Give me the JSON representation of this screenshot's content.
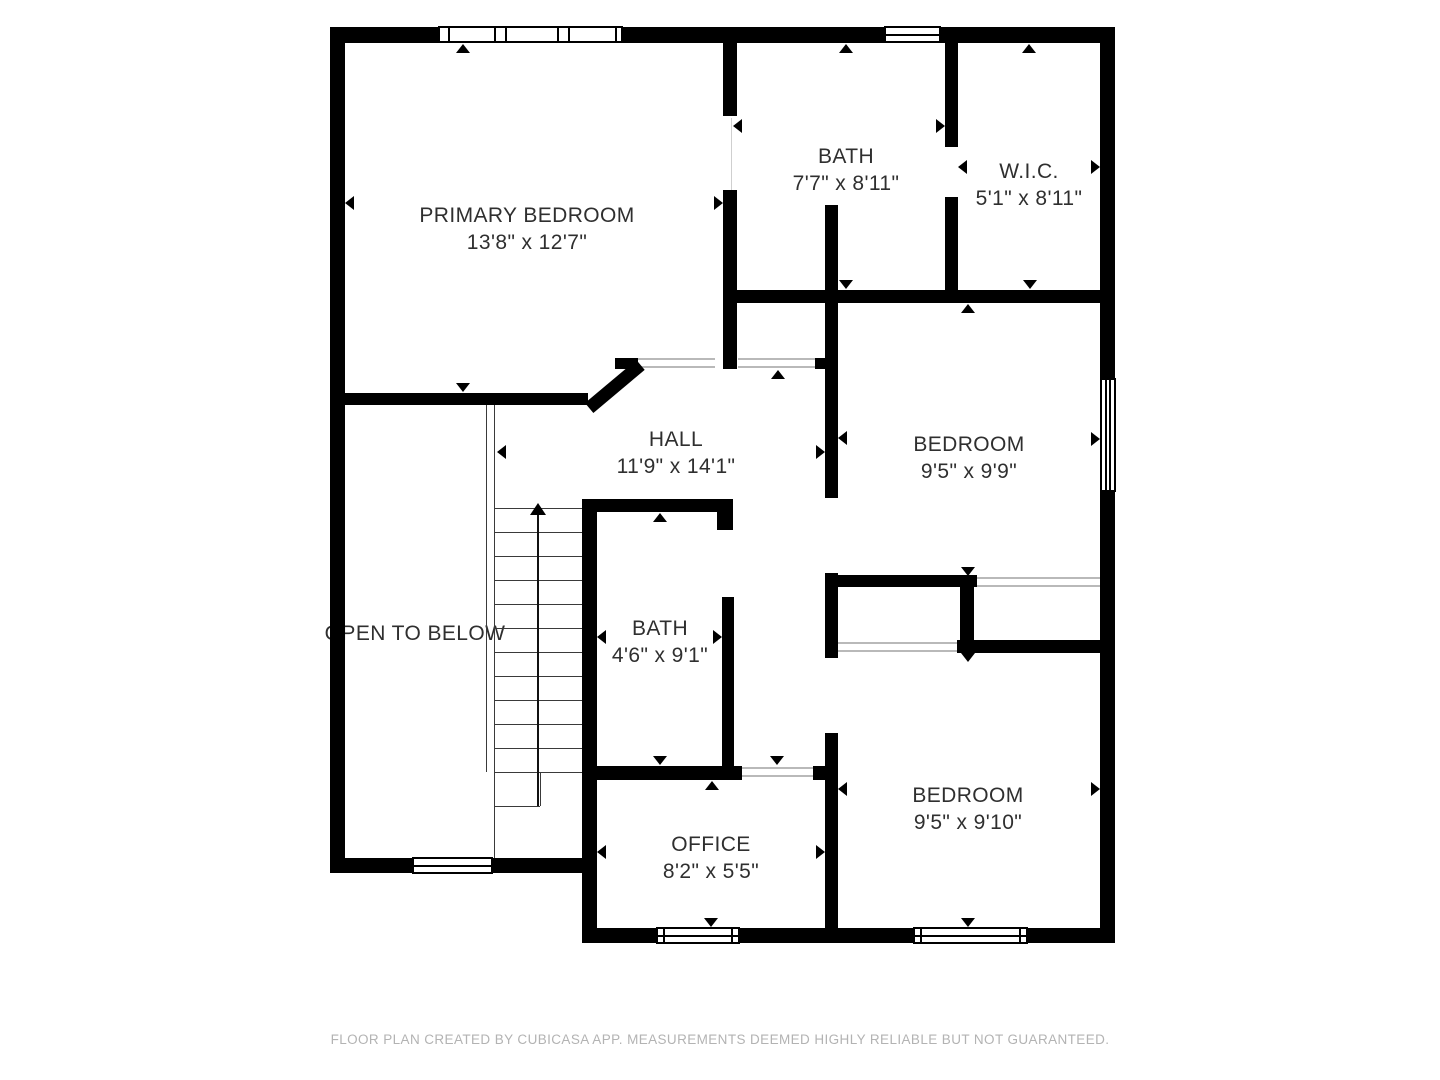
{
  "footer": {
    "disclaimer": "FLOOR PLAN CREATED BY CUBICASA APP. MEASUREMENTS DEEMED HIGHLY RELIABLE BUT NOT GUARANTEED."
  },
  "rooms": [
    {
      "name": "PRIMARY BEDROOM",
      "dims": "13'8\" x 12'7\"",
      "x": 527,
      "y": 202
    },
    {
      "name": "BATH",
      "dims": "7'7\" x 8'11\"",
      "x": 846,
      "y": 143
    },
    {
      "name": "W.I.C.",
      "dims": "5'1\" x 8'11\"",
      "x": 1029,
      "y": 158
    },
    {
      "name": "HALL",
      "dims": "11'9\" x 14'1\"",
      "x": 676,
      "y": 426
    },
    {
      "name": "BEDROOM",
      "dims": "9'5\" x 9'9\"",
      "x": 969,
      "y": 431
    },
    {
      "name": "OPEN TO BELOW",
      "dims": "",
      "x": 415,
      "y": 620
    },
    {
      "name": "BATH",
      "dims": "4'6\" x 9'1\"",
      "x": 660,
      "y": 615
    },
    {
      "name": "OFFICE",
      "dims": "8'2\" x 5'5\"",
      "x": 711,
      "y": 831
    },
    {
      "name": "BEDROOM",
      "dims": "9'5\" x 9'10\"",
      "x": 968,
      "y": 782
    }
  ],
  "colors": {
    "wall": "#000000",
    "text": "#2f2f2f",
    "threshold": "#b9b9b9",
    "stair_line": "#3a3a3a",
    "footer_text": "#b3b3b3",
    "background": "#ffffff"
  },
  "floorplan": {
    "walls": [
      [
        330,
        27,
        785,
        16
      ],
      [
        330,
        27,
        15,
        846
      ],
      [
        1100,
        27,
        15,
        916
      ],
      [
        330,
        858,
        262,
        15
      ],
      [
        582,
        499,
        15,
        444
      ],
      [
        582,
        928,
        533,
        15
      ],
      [
        330,
        393,
        258,
        12
      ],
      [
        615,
        358,
        23,
        11
      ],
      [
        815,
        358,
        23,
        11
      ],
      [
        723,
        43,
        14,
        73
      ],
      [
        723,
        190,
        14,
        179
      ],
      [
        945,
        43,
        13,
        104
      ],
      [
        945,
        197,
        13,
        105
      ],
      [
        723,
        290,
        392,
        13
      ],
      [
        825,
        205,
        13,
        293
      ],
      [
        825,
        573,
        13,
        85
      ],
      [
        825,
        733,
        13,
        210
      ],
      [
        825,
        575,
        152,
        12
      ],
      [
        960,
        575,
        14,
        70
      ],
      [
        957,
        640,
        146,
        13
      ],
      [
        582,
        499,
        151,
        13
      ],
      [
        717,
        499,
        16,
        31
      ],
      [
        722,
        597,
        12,
        181
      ],
      [
        582,
        766,
        160,
        14
      ],
      [
        813,
        766,
        14,
        14
      ]
    ],
    "diagonal": {
      "x": 585,
      "y": 403,
      "len": 67,
      "th": 13,
      "deg": -40
    },
    "windows": [
      {
        "x": 438,
        "y": 26,
        "w": 185,
        "h": 17,
        "type": "mullions",
        "lines": [
          8,
          54,
          65,
          117,
          128,
          175
        ]
      },
      {
        "x": 884,
        "y": 26,
        "w": 57,
        "h": 17,
        "type": "midh"
      },
      {
        "x": 1100,
        "y": 378,
        "w": 16,
        "h": 114,
        "type": "midv2"
      },
      {
        "x": 412,
        "y": 857,
        "w": 81,
        "h": 17,
        "type": "midh"
      },
      {
        "x": 656,
        "y": 927,
        "w": 84,
        "h": 17,
        "type": "midhcaps"
      },
      {
        "x": 913,
        "y": 927,
        "w": 115,
        "h": 17,
        "type": "midhcaps"
      }
    ],
    "thresholds": [
      [
        638,
        358,
        77
      ],
      [
        738,
        358,
        77
      ],
      [
        838,
        642,
        119
      ],
      [
        977,
        577,
        123
      ],
      [
        742,
        767,
        71
      ]
    ],
    "jambs": [
      [
        731,
        118,
        72
      ]
    ],
    "stairs": {
      "vlines": [
        [
          486,
          405,
          367
        ],
        [
          494,
          405,
          453
        ],
        [
          540,
          772,
          34
        ]
      ],
      "tread_x": 494,
      "tread_w": 88,
      "tread_ys": [
        508,
        532,
        556,
        580,
        604,
        628,
        652,
        676,
        700,
        724,
        748,
        772
      ],
      "landing": [
        494,
        806,
        46
      ],
      "arrow": {
        "x": 538,
        "y1": 514,
        "y2": 806,
        "head_y": 503
      }
    },
    "markers": [
      [
        463,
        44,
        "u"
      ],
      [
        846,
        44,
        "u"
      ],
      [
        1029,
        44,
        "u"
      ],
      [
        968,
        304,
        "u"
      ],
      [
        778,
        370,
        "u"
      ],
      [
        660,
        513,
        "u"
      ],
      [
        712,
        781,
        "u"
      ],
      [
        463,
        392,
        "d"
      ],
      [
        846,
        289,
        "d"
      ],
      [
        1030,
        289,
        "d"
      ],
      [
        968,
        576,
        "d"
      ],
      [
        777,
        765,
        "d"
      ],
      [
        660,
        765,
        "d"
      ],
      [
        711,
        927,
        "d"
      ],
      [
        968,
        927,
        "d"
      ],
      [
        968,
        662,
        "d"
      ],
      [
        345,
        203,
        "l"
      ],
      [
        733,
        126,
        "l"
      ],
      [
        958,
        167,
        "l"
      ],
      [
        838,
        438,
        "l"
      ],
      [
        497,
        452,
        "l"
      ],
      [
        597,
        637,
        "l"
      ],
      [
        597,
        852,
        "l"
      ],
      [
        838,
        789,
        "l"
      ],
      [
        723,
        203,
        "r"
      ],
      [
        945,
        126,
        "r"
      ],
      [
        1100,
        167,
        "r"
      ],
      [
        1100,
        439,
        "r"
      ],
      [
        825,
        452,
        "r"
      ],
      [
        722,
        637,
        "r"
      ],
      [
        825,
        852,
        "r"
      ],
      [
        1100,
        789,
        "r"
      ]
    ]
  }
}
